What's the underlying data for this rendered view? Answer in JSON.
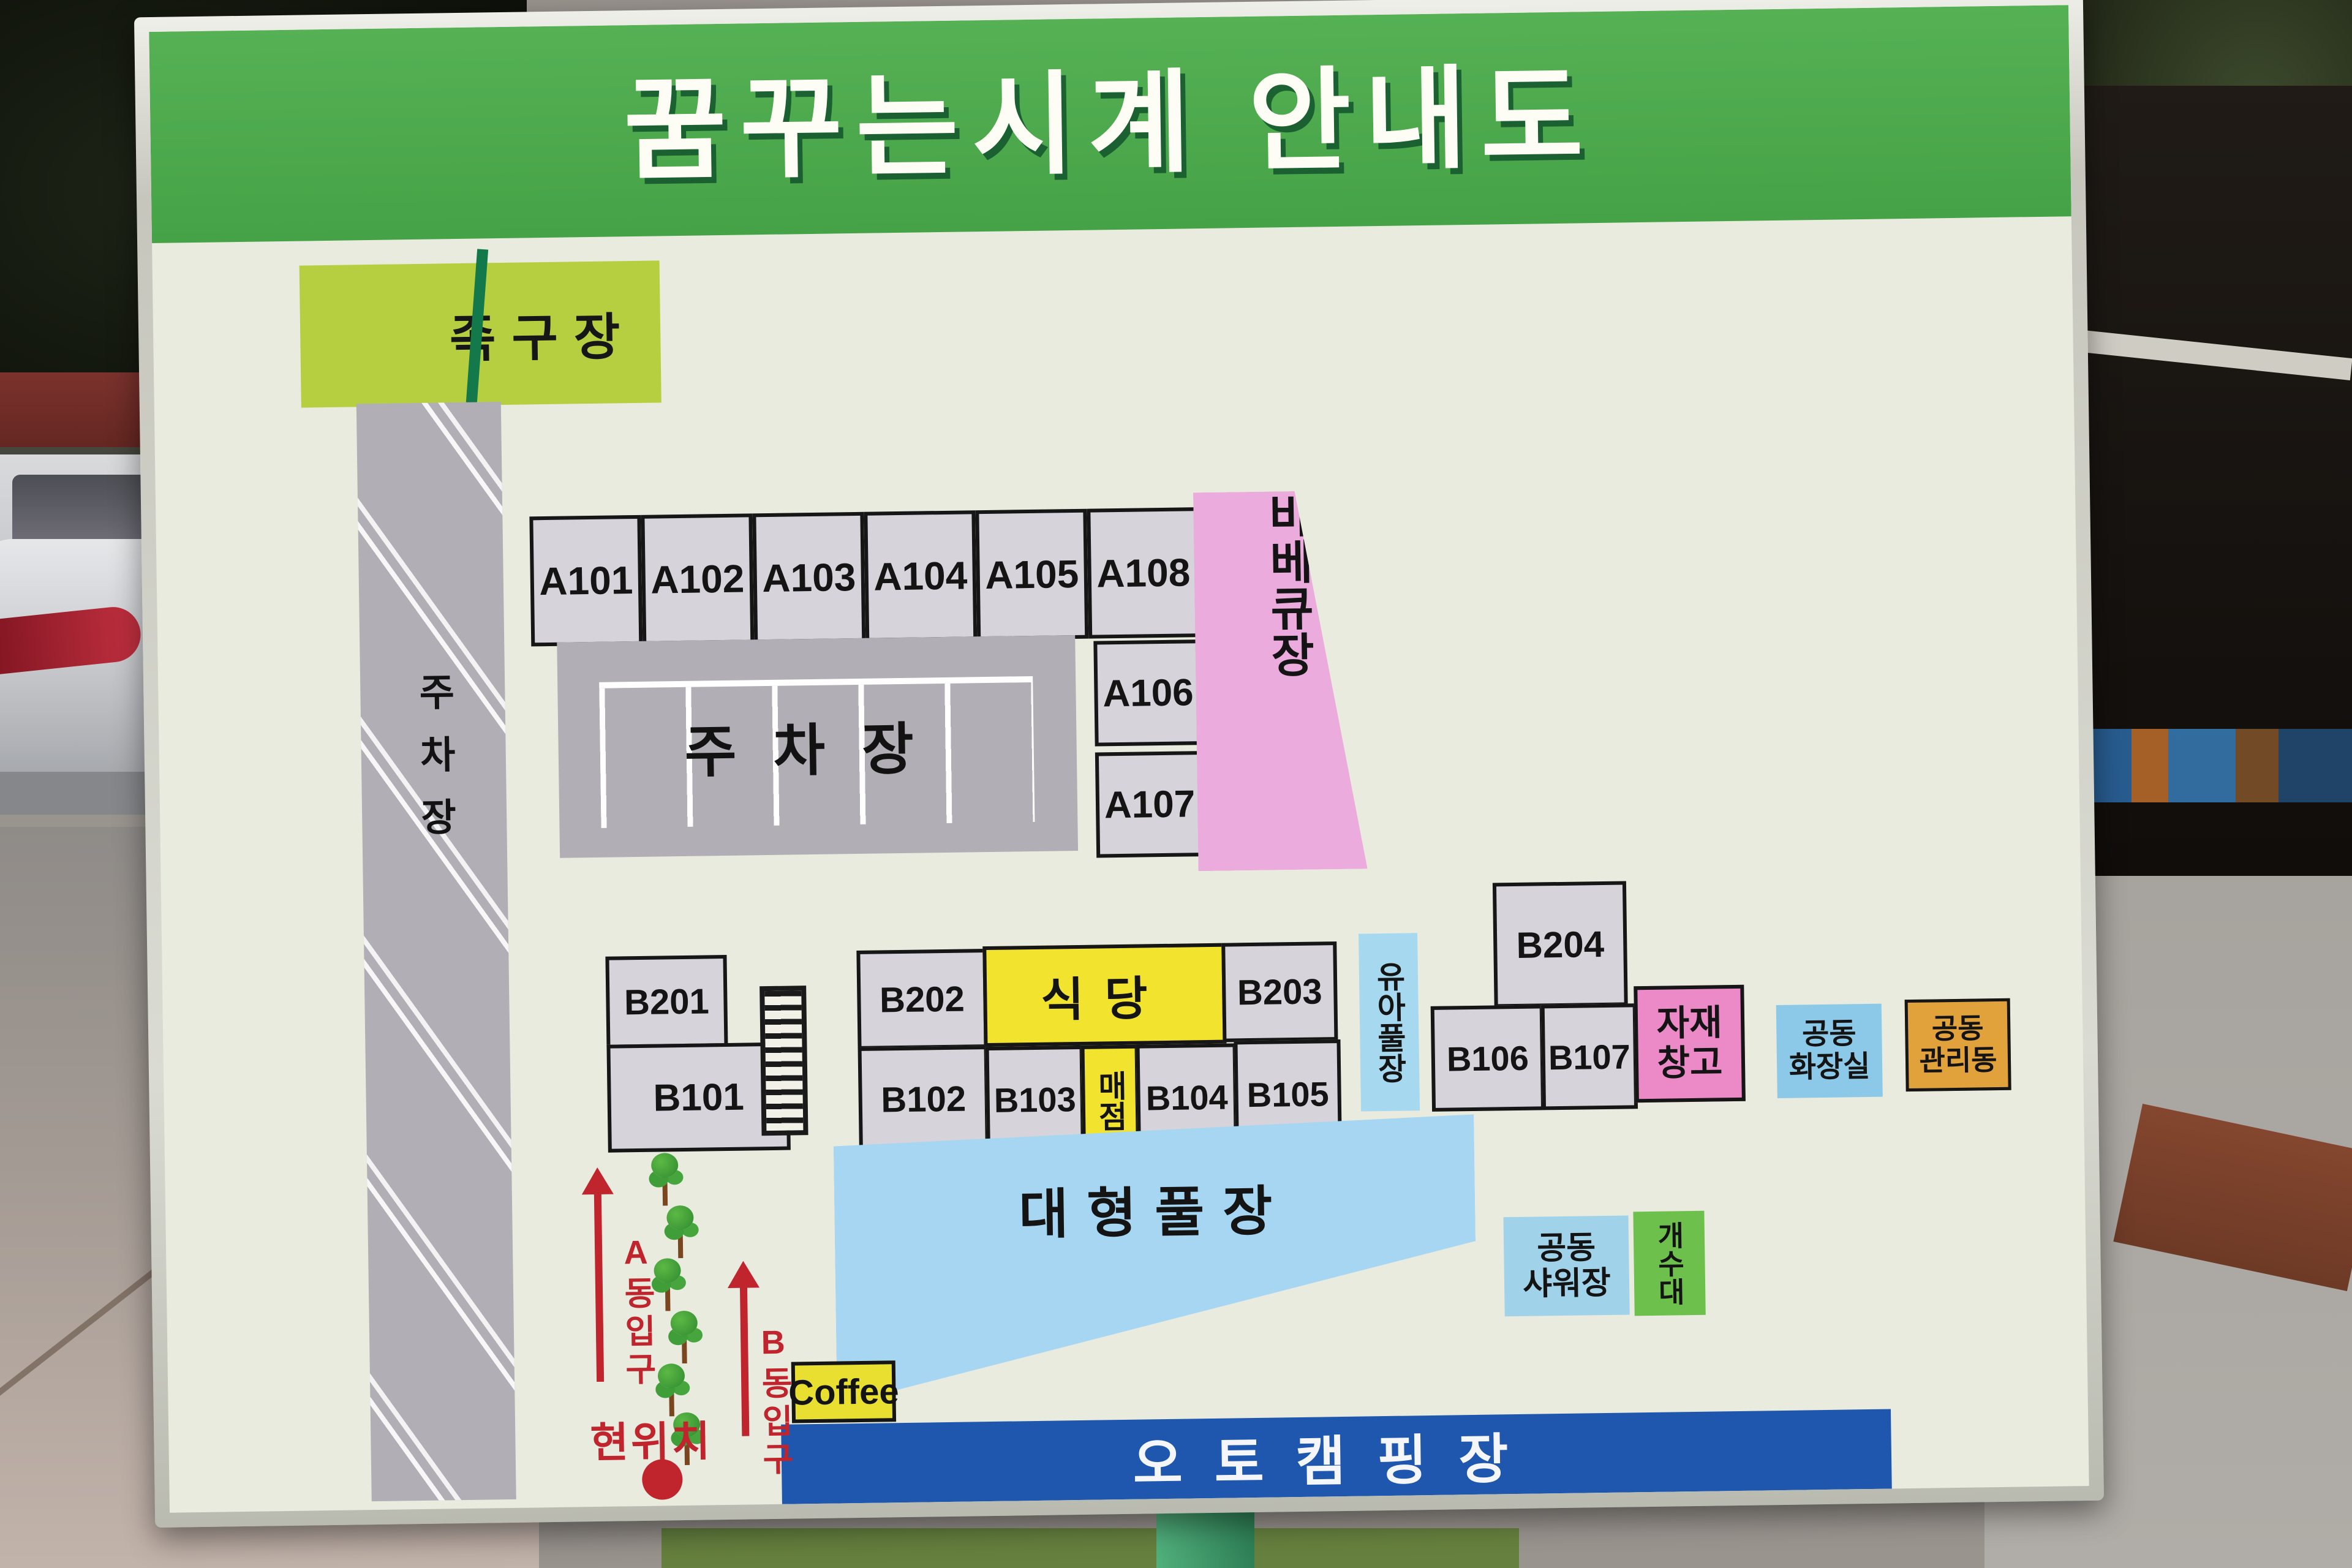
{
  "sign": {
    "title": "꿈꾸는시계 안내도",
    "labels": {
      "jokgu_court": "족구장",
      "road_parking": "주차장",
      "parking_lot": "주차장",
      "bbq": "바베큐장",
      "restaurant": "식당",
      "store": "매점",
      "infant_pool": "유아풀장",
      "materials_storage": "자재\n창고",
      "shared_toilet": "공동\n화장실",
      "shared_admin": "공동\n관리동",
      "large_pool": "대형풀장",
      "shared_shower": "공동\n샤워장",
      "sink_station": "개수대",
      "coffee": "Coffee",
      "auto_camping": "오토캠핑장",
      "current_location": "현위치",
      "entrance_a": "A동입구",
      "entrance_b": "B동입구"
    },
    "cabins": {
      "a_row": [
        "A101",
        "A102",
        "A103",
        "A104",
        "A105",
        "A108"
      ],
      "a_side": [
        "A106",
        "A107"
      ],
      "b_upper_left": "B201",
      "b_lower_left": "B101",
      "b_row_upper": [
        "B202",
        "B203"
      ],
      "b_row_lower": [
        "B102",
        "B103",
        "B104",
        "B105"
      ],
      "b_right_top": "B204",
      "b_right_lower": [
        "B106",
        "B107"
      ]
    },
    "colors": {
      "header_green": "#4FA94E",
      "panel_cream": "#E9EBDF",
      "cell_gray": "#D6D3DA",
      "road_gray": "#B2AEB5",
      "highlight_yellow": "#F2E32F",
      "bbq_pink": "#EBABDC",
      "storage_pink": "#EB8AC6",
      "pool_blue": "#A6D6F2",
      "toilet_blue": "#8CC9E8",
      "sink_green": "#6EC04C",
      "admin_orange": "#E1A23C",
      "camp_blue": "#1F57AE",
      "jokgu_chartreuse": "#B6CF40",
      "marker_red": "#C0242C"
    }
  }
}
